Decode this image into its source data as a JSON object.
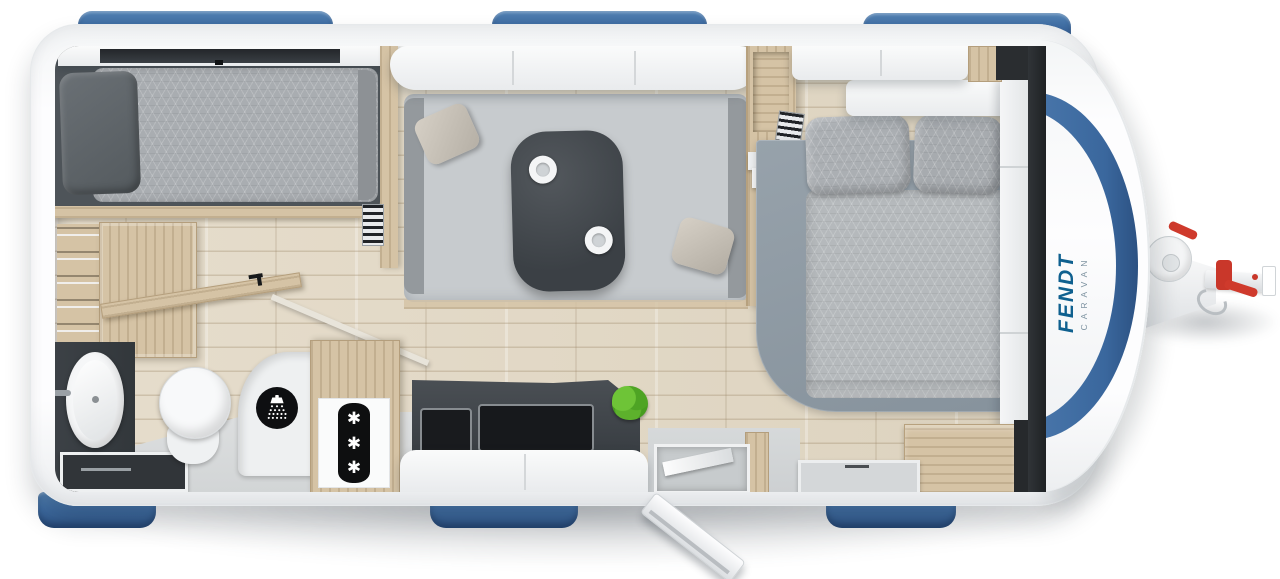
{
  "scene": {
    "description": "Top-view interior floor plan of a Fendt caravan with rear single bed, washroom, kitchen, dinette and front french bed",
    "background": "#ffffff"
  },
  "branding": {
    "brand": "FENDT",
    "sub_brand": "CARAVAN",
    "brand_color": "#0f608f",
    "sub_color": "#7e93a1"
  },
  "palette": {
    "window_blue": "#3f6da3",
    "body_white": "#fbfcfd",
    "cabinet_wood": "#d5c3a5",
    "floor_wood": "#e2d9c8",
    "dark_bed_base": "#4e5459",
    "mattress_gray": "#a9adb1",
    "sofa_gray": "#c7cbce",
    "table_charcoal": "#42474c",
    "bed_platform_gray": "#8f9aa3",
    "vinyl_gray": "#d8dadb",
    "fixture_white": "#f4f5f6",
    "icon_black": "#101113",
    "plant_green": "#5cb52f",
    "hitch_red": "#cf3a2c"
  },
  "fixtures": {
    "fridge_icon": {
      "name": "snowflake-icon",
      "glyph": "✱",
      "count": 3
    },
    "shower_icon": {
      "name": "shower-head-icon"
    },
    "cups_on_table": 2,
    "windows": {
      "top": 3,
      "bottom": 3,
      "front": 1
    }
  }
}
